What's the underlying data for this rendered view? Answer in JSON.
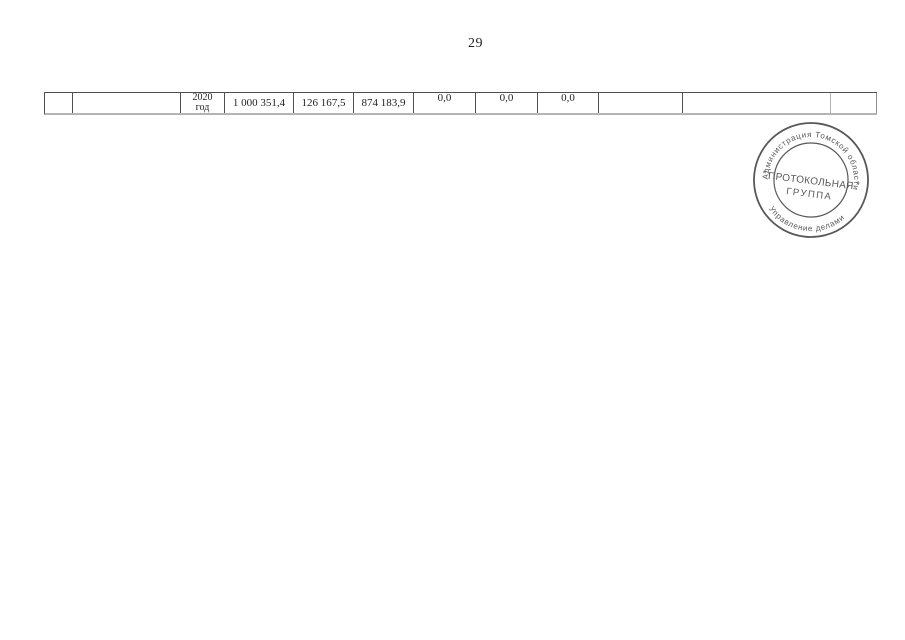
{
  "page": {
    "number": "29"
  },
  "table": {
    "cells": [
      "",
      "",
      "2020\nгод",
      "1 000 351,4",
      "126 167,5",
      "874 183,9",
      "0,0",
      "0,0",
      "0,0",
      "",
      "",
      ""
    ]
  },
  "stamp": {
    "arc_top": "Администрация Томской области",
    "center_line1": "ПРОТОКОЛЬНАЯ",
    "center_line2": "ГРУППА",
    "arc_bottom": "Управление делами",
    "star_left": "*",
    "star_right": "*"
  },
  "colors": {
    "border_dark": "#4f4f4f",
    "border_light": "#b4b4b4",
    "text_color": "#1f1f1f",
    "stamp_ink": "#4a4a4a"
  }
}
